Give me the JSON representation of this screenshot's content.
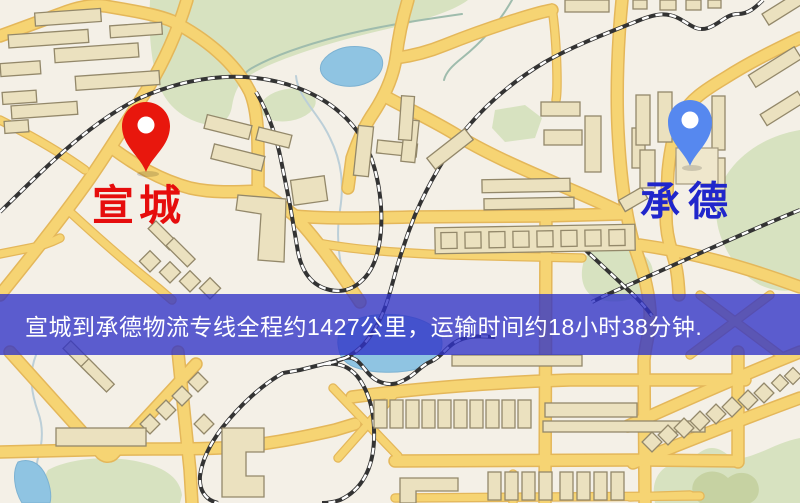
{
  "banner": {
    "text": "宣城到承德物流专线全程约1427公里，运输时间约18小时38分钟."
  },
  "pins": [
    {
      "id": "origin",
      "label": "宣城",
      "color": "#e8170d",
      "label_color": "#e60d0d"
    },
    {
      "id": "destination",
      "label": "承德",
      "color": "#5688ef",
      "label_color": "#2026cb"
    }
  ],
  "colors": {
    "banner_bg": "#3032c6",
    "road": "#f6d473",
    "railway": "#333333",
    "water": "#8fc4e2",
    "park": "#d7e2c0",
    "building": "#ebe1bf",
    "background": "#f4f0e7"
  }
}
